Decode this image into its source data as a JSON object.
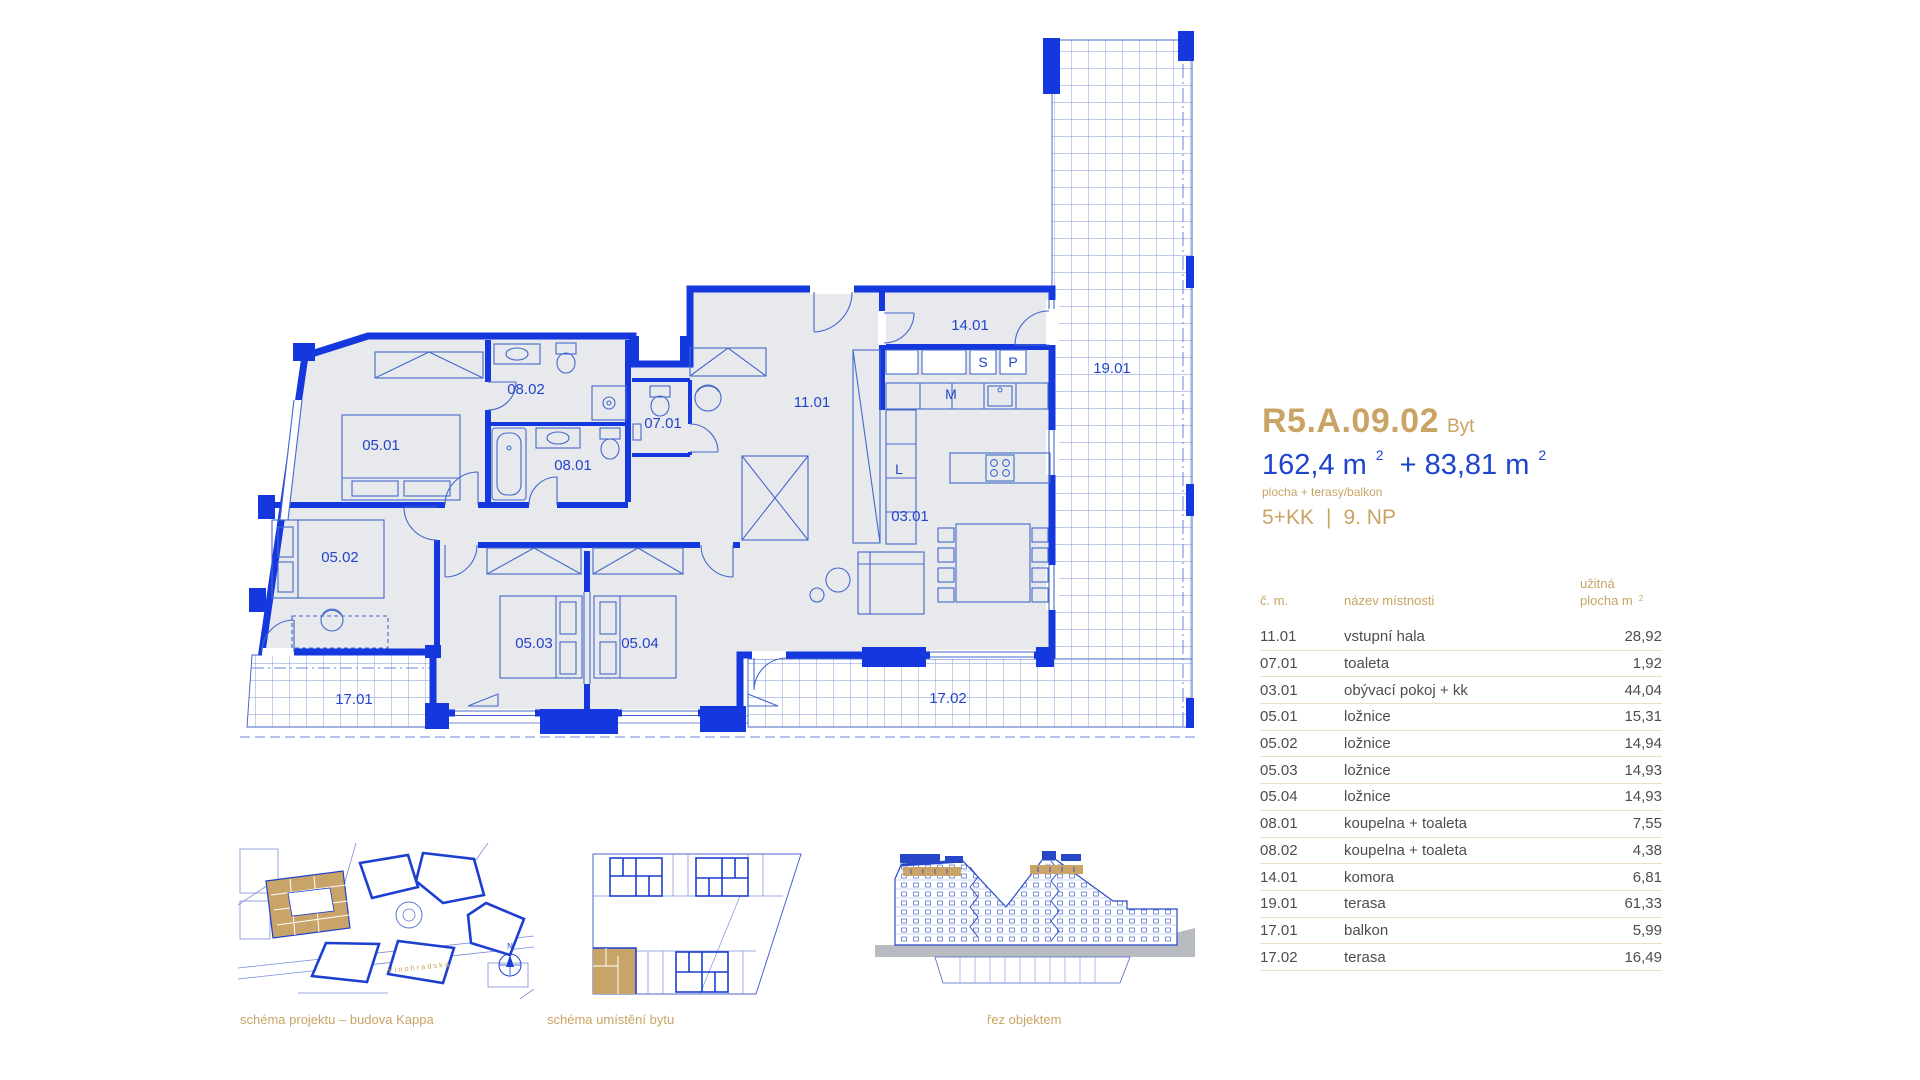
{
  "panel": {
    "unit_code": "R5.A.09.02",
    "unit_type": "Byt",
    "area_main": "162,4 m",
    "area_plus": "+ 83,81 m",
    "sup": "2",
    "area_note": "plocha + terasy/balkon",
    "disposition": "5+KK",
    "separator": "|",
    "floor": "9. NP"
  },
  "table": {
    "headers": {
      "col_number": "č. m.",
      "col_name": "název místnosti",
      "col_area_line1": "užitná",
      "col_area_line2": "plocha m",
      "col_area_sup": "2"
    },
    "rows": [
      {
        "number": "11.01",
        "name": "vstupní hala",
        "area": "28,92"
      },
      {
        "number": "07.01",
        "name": "toaleta",
        "area": "1,92"
      },
      {
        "number": "03.01",
        "name": "obývací pokoj + kk",
        "area": "44,04"
      },
      {
        "number": "05.01",
        "name": "ložnice",
        "area": "15,31"
      },
      {
        "number": "05.02",
        "name": "ložnice",
        "area": "14,94"
      },
      {
        "number": "05.03",
        "name": "ložnice",
        "area": "14,93"
      },
      {
        "number": "05.04",
        "name": "ložnice",
        "area": "14,93"
      },
      {
        "number": "08.01",
        "name": "koupelna + toaleta",
        "area": "7,55"
      },
      {
        "number": "08.02",
        "name": "koupelna + toaleta",
        "area": "4,38"
      },
      {
        "number": "14.01",
        "name": "komora",
        "area": "6,81"
      },
      {
        "number": "19.01",
        "name": "terasa",
        "area": "61,33"
      },
      {
        "number": "17.01",
        "name": "balkon",
        "area": "5,99"
      },
      {
        "number": "17.02",
        "name": "terasa",
        "area": "16,49"
      }
    ]
  },
  "floor_plan": {
    "room_labels": [
      {
        "id": "05.01",
        "x": 381,
        "y": 450
      },
      {
        "id": "08.02",
        "x": 526,
        "y": 394
      },
      {
        "id": "07.01",
        "x": 663,
        "y": 428
      },
      {
        "id": "08.01",
        "x": 573,
        "y": 470
      },
      {
        "id": "11.01",
        "x": 812,
        "y": 407
      },
      {
        "id": "14.01",
        "x": 970,
        "y": 330
      },
      {
        "id": "19.01",
        "x": 1112,
        "y": 373
      },
      {
        "id": "03.01",
        "x": 910,
        "y": 521
      },
      {
        "id": "05.02",
        "x": 340,
        "y": 562
      },
      {
        "id": "05.03",
        "x": 534,
        "y": 648
      },
      {
        "id": "05.04",
        "x": 640,
        "y": 648
      },
      {
        "id": "17.01",
        "x": 354,
        "y": 704
      },
      {
        "id": "17.02",
        "x": 948,
        "y": 703
      }
    ],
    "appliance_labels": [
      {
        "id": "S",
        "x": 983,
        "y": 367
      },
      {
        "id": "P",
        "x": 1013,
        "y": 367
      },
      {
        "id": "M",
        "x": 951,
        "y": 399
      },
      {
        "id": "L",
        "x": 899,
        "y": 474
      }
    ]
  },
  "captions": {
    "site": "schéma projektu – budova Kappa",
    "position": "schéma umístění bytu",
    "section": "řez objektem"
  },
  "map": {
    "street": "Vinohradská",
    "compass": "N"
  },
  "colors": {
    "wall_blue": "#1537de",
    "line_blue": "#4468cc",
    "label_blue": "#2444cb",
    "accent_gold": "#c9a464",
    "table_text": "#4c4d52",
    "floor_gray": "#e8e9ed",
    "ground_gray": "#b8bcc1"
  }
}
